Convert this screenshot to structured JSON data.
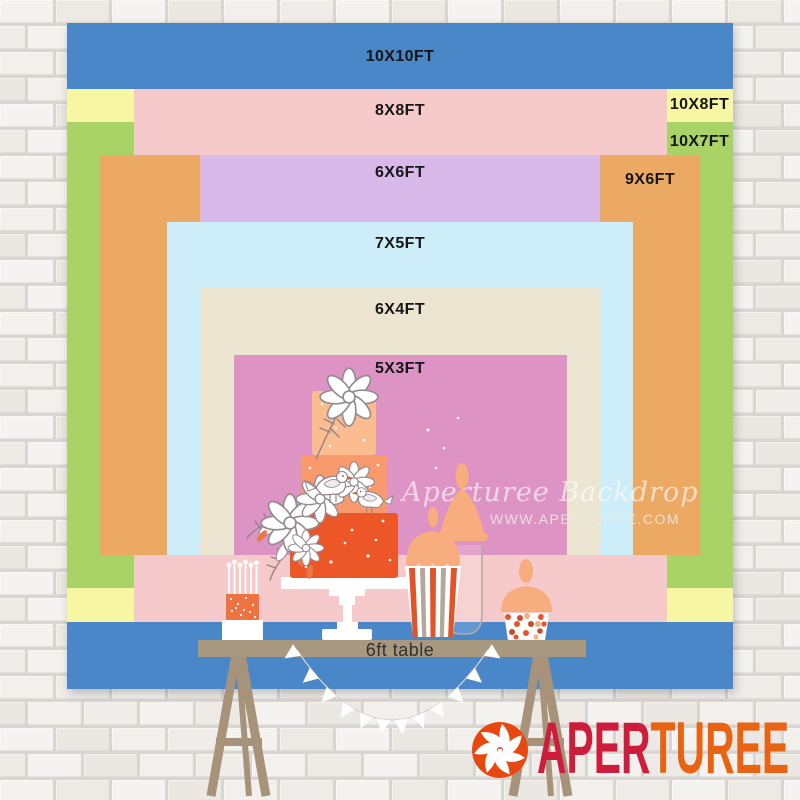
{
  "product_chart": {
    "sizes": [
      {
        "id": "10x10",
        "label": "10X10FT",
        "color": "#4a87c9"
      },
      {
        "id": "8x8",
        "label": "8X8FT",
        "color": "#f6caca"
      },
      {
        "id": "10x8",
        "label": "10X8FT",
        "color": "#f7f7a3"
      },
      {
        "id": "10x7",
        "label": "10X7FT",
        "color": "#a9d366"
      },
      {
        "id": "6x6",
        "label": "6X6FT",
        "color": "#d9b9ea"
      },
      {
        "id": "9x6",
        "label": "9X6FT",
        "color": "#eba963"
      },
      {
        "id": "7x5",
        "label": "7X5FT",
        "color": "#cdedf8"
      },
      {
        "id": "6x4",
        "label": "6X4FT",
        "color": "#ece5d2"
      },
      {
        "id": "5x3",
        "label": "5X3FT",
        "color": "#dd93c3"
      }
    ],
    "table_label": "6ft table"
  },
  "watermark": {
    "brand_script": "Aperturee Backdrop",
    "website": "WWW.APERTUREE.COM"
  },
  "logo": {
    "word_part1": "APER",
    "word_part2": "TUREE",
    "part1_color": "#ce1d3c",
    "part2_color": "#e96412",
    "icon_color": "#e8480f",
    "icon": "aperture-shutter"
  }
}
